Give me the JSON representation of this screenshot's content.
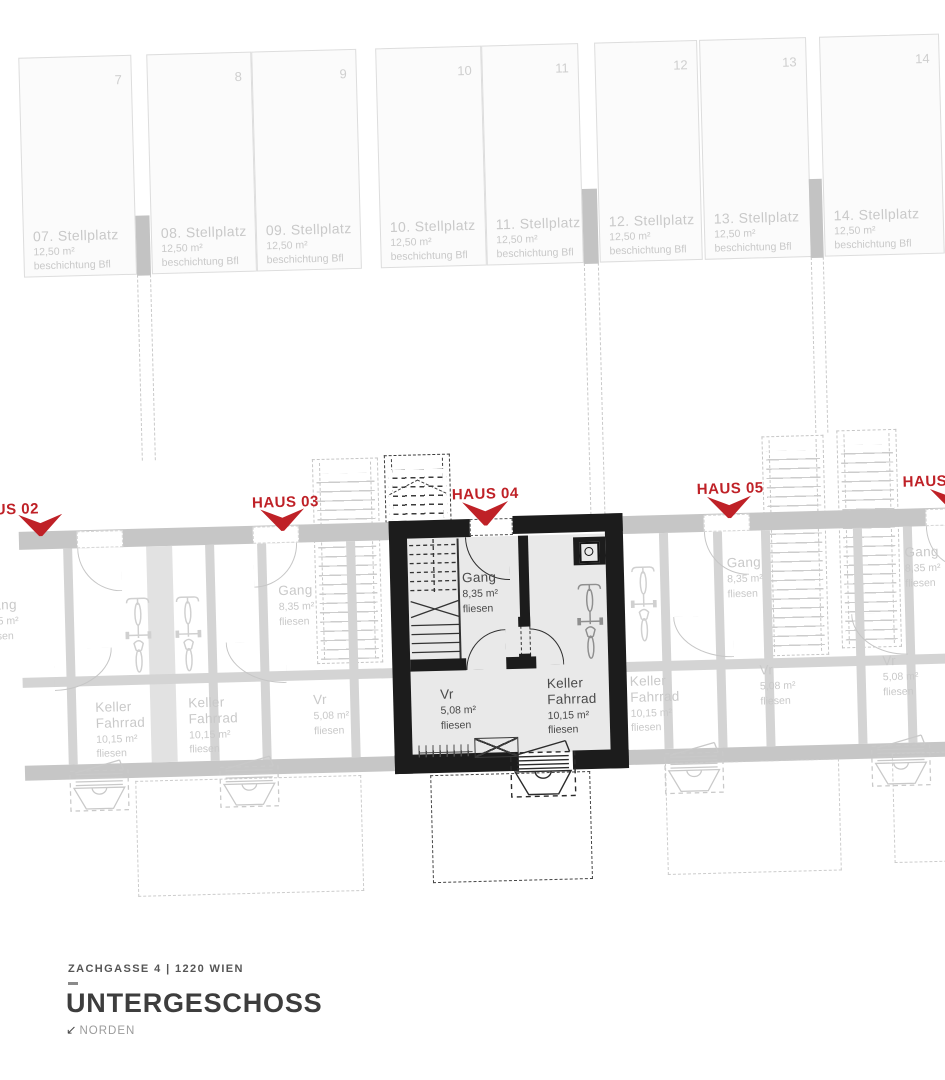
{
  "title_block": {
    "address": "ZACHGASSE 4 | 1220 WIEN",
    "floor_title": "UNTERGESCHOSS",
    "north_label": "NORDEN",
    "north_arrow": "↙"
  },
  "colors": {
    "accent_red": "#bf2127",
    "wall_dark": "#1c1c1c",
    "floor_gray": "#e9e9e9",
    "faded_gray": "#c9c9c9"
  },
  "parking": {
    "stalls": [
      {
        "num": "7",
        "name": "07. Stellplatz",
        "area": "12,50 m²",
        "surface": "beschichtung Bfl"
      },
      {
        "num": "8",
        "name": "08. Stellplatz",
        "area": "12,50 m²",
        "surface": "beschichtung Bfl"
      },
      {
        "num": "9",
        "name": "09. Stellplatz",
        "area": "12,50 m²",
        "surface": "beschichtung Bfl"
      },
      {
        "num": "10",
        "name": "10. Stellplatz",
        "area": "12,50 m²",
        "surface": "beschichtung Bfl"
      },
      {
        "num": "11",
        "name": "11. Stellplatz",
        "area": "12,50 m²",
        "surface": "beschichtung Bfl"
      },
      {
        "num": "12",
        "name": "12. Stellplatz",
        "area": "12,50 m²",
        "surface": "beschichtung Bfl"
      },
      {
        "num": "13",
        "name": "13. Stellplatz",
        "area": "12,50 m²",
        "surface": "beschichtung Bfl"
      },
      {
        "num": "14",
        "name": "14. Stellplatz",
        "area": "12,50 m²",
        "surface": "beschichtung Bfl"
      }
    ]
  },
  "houses": {
    "h02": {
      "label": "HAUS 02",
      "gang": {
        "name": "Gang",
        "area": "8,35 m²",
        "finish": "fliesen"
      },
      "keller": {
        "name": "Keller Fahrrad",
        "area": "10,15 m²",
        "finish": "fliesen"
      }
    },
    "h03": {
      "label": "HAUS 03",
      "gang": {
        "name": "Gang",
        "area": "8,35 m²",
        "finish": "fliesen"
      },
      "vr": {
        "name": "Vr",
        "area": "5,08 m²",
        "finish": "fliesen"
      },
      "keller": {
        "name": "Keller Fahrrad",
        "area": "10,15 m²",
        "finish": "fliesen"
      }
    },
    "h04": {
      "label": "HAUS 04",
      "gang": {
        "name": "Gang",
        "area": "8,35 m²",
        "finish": "fliesen"
      },
      "vr": {
        "name": "Vr",
        "area": "5,08 m²",
        "finish": "fliesen"
      },
      "keller": {
        "name": "Keller Fahrrad",
        "area": "10,15 m²",
        "finish": "fliesen"
      }
    },
    "h05": {
      "label": "HAUS 05",
      "gang": {
        "name": "Gang",
        "area": "8,35 m²",
        "finish": "fliesen"
      },
      "vr": {
        "name": "Vr",
        "area": "5,08 m²",
        "finish": "fliesen"
      },
      "keller": {
        "name": "Keller Fahrrad",
        "area": "10,15 m²",
        "finish": "fliesen"
      }
    },
    "h06": {
      "label": "HAUS 06",
      "gang": {
        "name": "Gang",
        "area": "8,35 m²",
        "finish": "fliesen"
      },
      "vr": {
        "name": "Vr",
        "area": "5,08 m²",
        "finish": "fliesen"
      }
    }
  }
}
